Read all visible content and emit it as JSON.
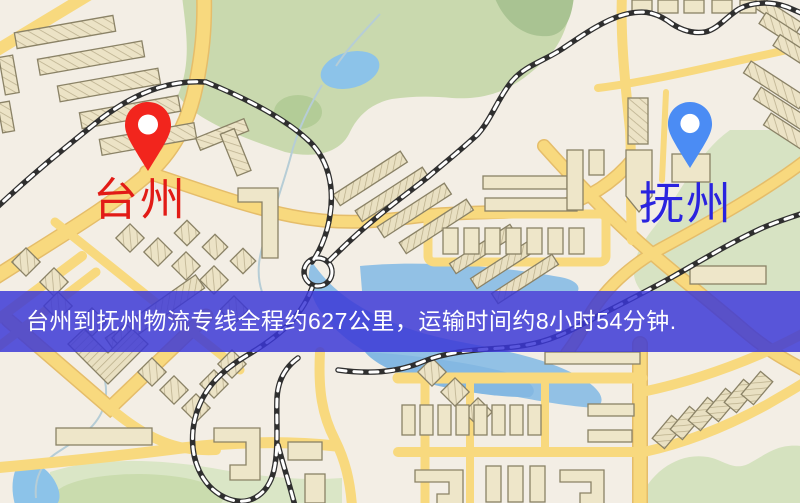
{
  "map": {
    "origin": {
      "name": "台州",
      "label_color": "#e21b16",
      "pin_color": "#f2251d",
      "pin_icon": "map-pin-icon"
    },
    "destination": {
      "name": "抚州",
      "label_color": "#2a23df",
      "pin_color": "#4b8cf4",
      "pin_icon": "map-pin-icon"
    }
  },
  "banner": {
    "text": "台州到抚州物流专线全程约627公里，运输时间约8小时54分钟.",
    "distance_text": "约627公里",
    "duration_text": "约8小时54分钟",
    "background_color": "rgba(58,55,214,0.84)",
    "text_color": "#ffffff"
  },
  "map_style": {
    "background_color": "#f3eee5",
    "road_color": "#f8d97e",
    "road_casing_color": "#e5bd6a",
    "park_color": "#c9d9ae",
    "water_color": "#8cc3e9",
    "building_color": "#ece3c6",
    "railway_color": "#2f2f2f"
  }
}
